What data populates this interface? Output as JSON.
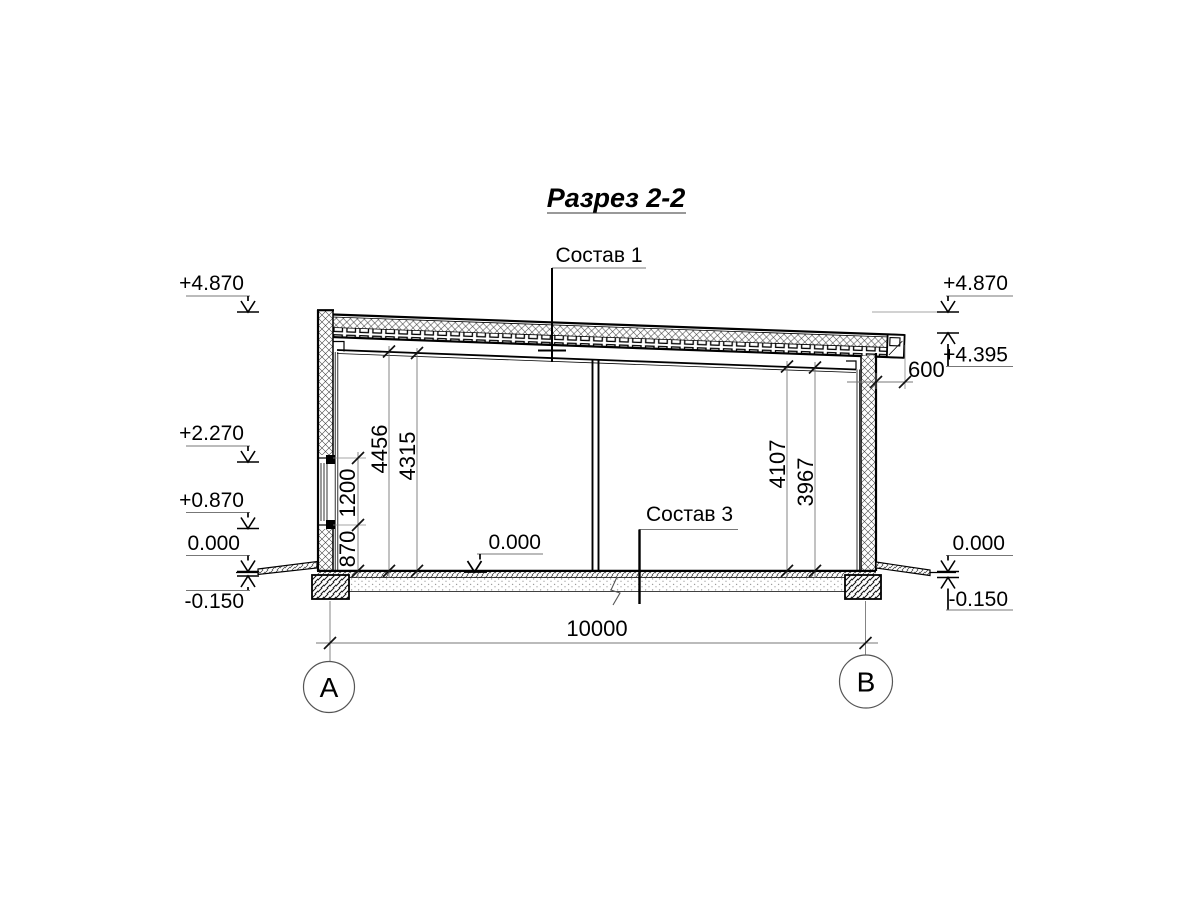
{
  "title": "Разрез 2-2",
  "callouts": {
    "roof": "Состав 1",
    "floor": "Состав 3"
  },
  "elevation_marks": {
    "left": [
      "+4.870",
      "+2.270",
      "+0.870",
      "0.000",
      "-0.150"
    ],
    "right": [
      "+4.870",
      "+4.395",
      "0.000",
      "-0.150"
    ],
    "floor_mid": "0.000"
  },
  "dimensions": {
    "span": "10000",
    "roof_overhang": "600",
    "window_sill_height": "870",
    "window_height": "1200",
    "interior_heights_left": [
      "4456",
      "4315"
    ],
    "interior_heights_right": [
      "4107",
      "3967"
    ]
  },
  "axes": [
    "А",
    "В"
  ]
}
